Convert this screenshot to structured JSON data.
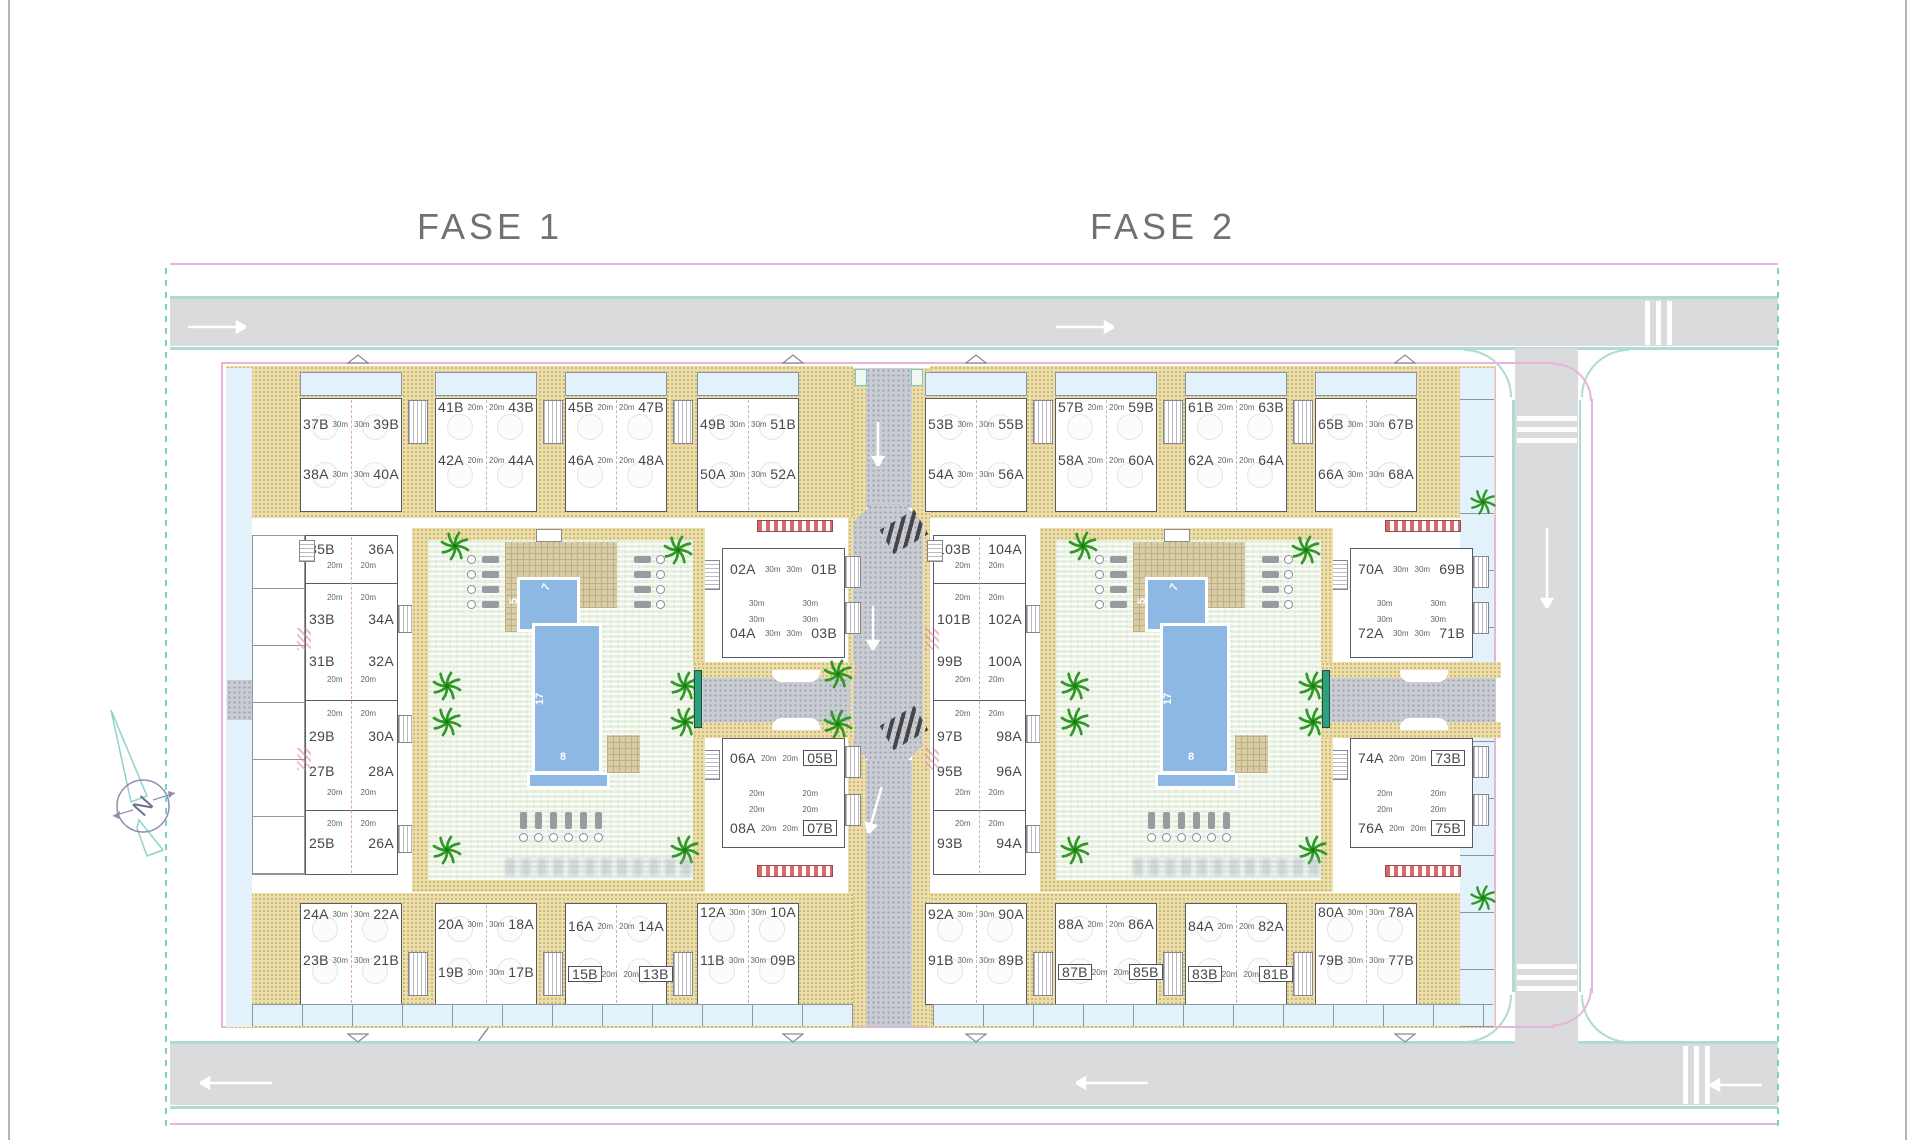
{
  "page": {
    "title_fase1": "FASE 1",
    "title_fase2": "FASE 2",
    "pilotos": "Pilotos",
    "compass_letter": "N"
  },
  "pool": {
    "length": "17",
    "width": "8",
    "head_width": "5",
    "head_length": "7"
  },
  "colors": {
    "road": "#dadbdc",
    "sidewalk_edge": "#aedbd3",
    "boundary_pink": "#e9b4da",
    "path_tan": "#ecdfad",
    "courtyard_green": "#e9f1e3",
    "pool_blue": "#8db8e4",
    "palm_green": "#2d9a24",
    "label_gray": "#46464d"
  },
  "phases": [
    {
      "name": "FASE 1",
      "left_col_size": "20m",
      "top_row": [
        {
          "top": [
            "37B",
            "39B"
          ],
          "bottom": [
            "38A",
            "40A"
          ],
          "size": "30m",
          "boxed": []
        },
        {
          "top": [
            "41B",
            "43B"
          ],
          "bottom": [
            "42A",
            "44A"
          ],
          "size": "20m",
          "boxed": []
        },
        {
          "top": [
            "45B",
            "47B"
          ],
          "bottom": [
            "46A",
            "48A"
          ],
          "size": "20m",
          "boxed": []
        },
        {
          "top": [
            "49B",
            "51B"
          ],
          "bottom": [
            "50A",
            "52A"
          ],
          "size": "30m",
          "boxed": []
        }
      ],
      "left_col": [
        {
          "left": "35B",
          "right": "36A"
        },
        {
          "left": "33B",
          "right": "34A"
        },
        {
          "left": "31B",
          "right": "32A"
        },
        {
          "left": "29B",
          "right": "30A"
        },
        {
          "left": "27B",
          "right": "28A"
        },
        {
          "left": "25B",
          "right": "26A"
        }
      ],
      "mid_col": [
        {
          "top": [
            "02A",
            "01B"
          ],
          "bottom": [
            "04A",
            "03B"
          ],
          "size": "30m",
          "boxed": []
        },
        {
          "top": [
            "06A",
            "05B"
          ],
          "bottom": [
            "08A",
            "07B"
          ],
          "size": "20m",
          "boxed": [
            "05B",
            "07B"
          ]
        }
      ],
      "bottom_row": [
        {
          "top": [
            "24A",
            "22A"
          ],
          "bottom": [
            "23B",
            "21B"
          ],
          "size": "30m",
          "boxed": []
        },
        {
          "top": [
            "20A",
            "18A"
          ],
          "bottom": [
            "19B",
            "17B"
          ],
          "size": "30m",
          "boxed": []
        },
        {
          "top": [
            "16A",
            "14A"
          ],
          "bottom": [
            "15B",
            "13B"
          ],
          "size": "20m",
          "boxed": [
            "15B",
            "13B"
          ]
        },
        {
          "top": [
            "12A",
            "10A"
          ],
          "bottom": [
            "11B",
            "09B"
          ],
          "size": "30m",
          "boxed": []
        }
      ]
    },
    {
      "name": "FASE 2",
      "left_col_size": "20m",
      "top_row": [
        {
          "top": [
            "53B",
            "55B"
          ],
          "bottom": [
            "54A",
            "56A"
          ],
          "size": "30m",
          "boxed": []
        },
        {
          "top": [
            "57B",
            "59B"
          ],
          "bottom": [
            "58A",
            "60A"
          ],
          "size": "20m",
          "boxed": []
        },
        {
          "top": [
            "61B",
            "63B"
          ],
          "bottom": [
            "62A",
            "64A"
          ],
          "size": "20m",
          "boxed": []
        },
        {
          "top": [
            "65B",
            "67B"
          ],
          "bottom": [
            "66A",
            "68A"
          ],
          "size": "30m",
          "boxed": []
        }
      ],
      "left_col": [
        {
          "left": "103B",
          "right": "104A"
        },
        {
          "left": "101B",
          "right": "102A"
        },
        {
          "left": "99B",
          "right": "100A"
        },
        {
          "left": "97B",
          "right": "98A"
        },
        {
          "left": "95B",
          "right": "96A"
        },
        {
          "left": "93B",
          "right": "94A"
        }
      ],
      "mid_col": [
        {
          "top": [
            "70A",
            "69B"
          ],
          "bottom": [
            "72A",
            "71B"
          ],
          "size": "30m",
          "boxed": []
        },
        {
          "top": [
            "74A",
            "73B"
          ],
          "bottom": [
            "76A",
            "75B"
          ],
          "size": "20m",
          "boxed": [
            "73B",
            "75B"
          ]
        }
      ],
      "bottom_row": [
        {
          "top": [
            "92A",
            "90A"
          ],
          "bottom": [
            "91B",
            "89B"
          ],
          "size": "30m",
          "boxed": []
        },
        {
          "top": [
            "88A",
            "86A"
          ],
          "bottom": [
            "87B",
            "85B"
          ],
          "size": "20m",
          "boxed": [
            "87B",
            "85B"
          ]
        },
        {
          "top": [
            "84A",
            "82A"
          ],
          "bottom": [
            "83B",
            "81B"
          ],
          "size": "20m",
          "boxed": [
            "83B",
            "81B"
          ]
        },
        {
          "top": [
            "80A",
            "78A"
          ],
          "bottom": [
            "79B",
            "77B"
          ],
          "size": "30m",
          "boxed": []
        }
      ]
    }
  ]
}
